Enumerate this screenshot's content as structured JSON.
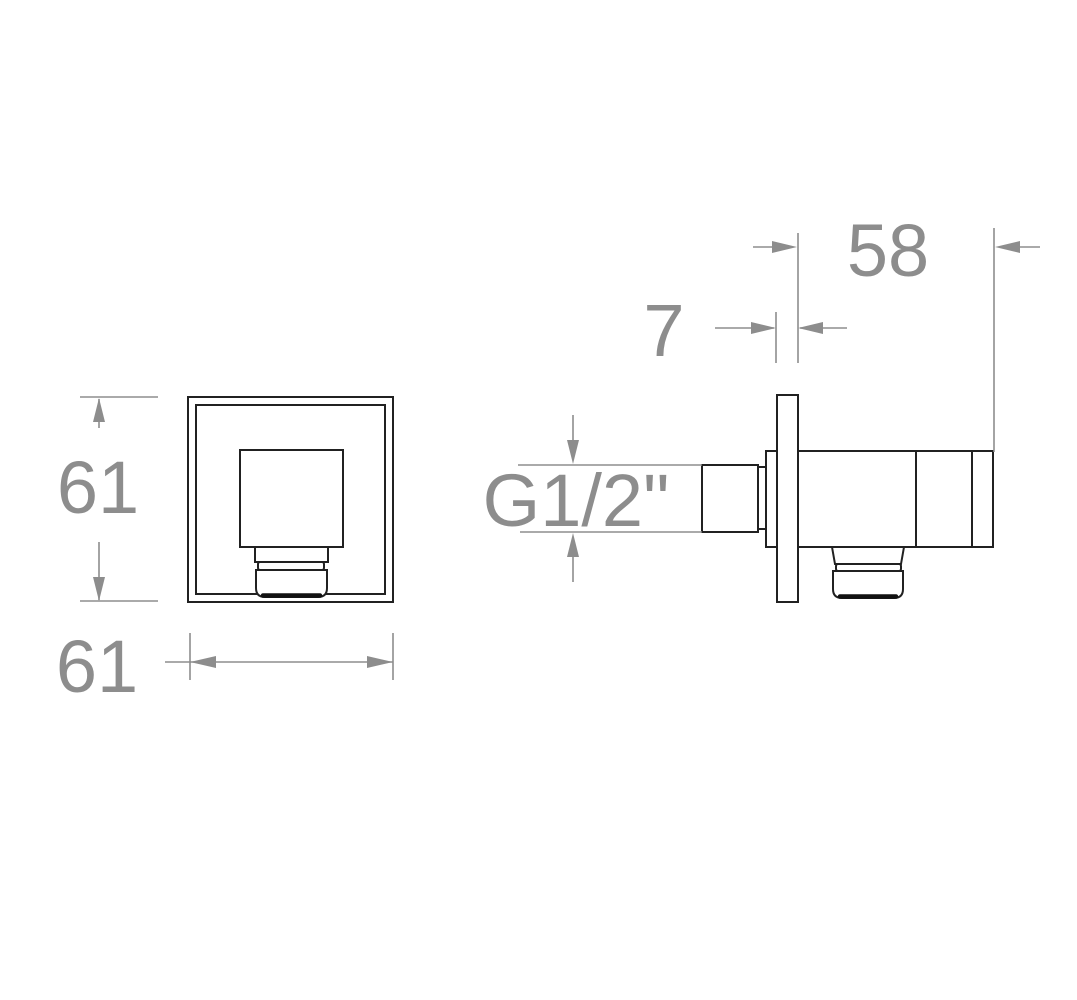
{
  "drawing": {
    "colors": {
      "outline": "#212121",
      "dimension": "#8d8d8d",
      "background": "#ffffff"
    },
    "front_view": {
      "height_label": "61",
      "width_label": "61"
    },
    "side_view": {
      "depth_label": "58",
      "plate_thickness_label": "7",
      "thread_label": "G1/2\""
    }
  }
}
